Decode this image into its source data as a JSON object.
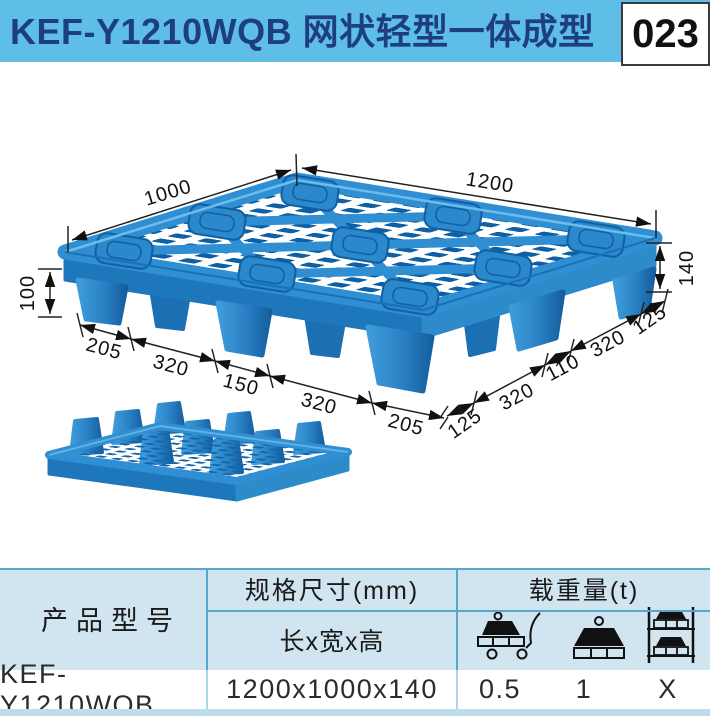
{
  "header": {
    "title": "KEF-Y1210WQB 网状轻型一体成型",
    "page_number": "023"
  },
  "drawing": {
    "dim_length": "1200",
    "dim_width": "1000",
    "dim_height": "140",
    "dim_foot_height": "100",
    "front_chain": [
      "205",
      "320",
      "150",
      "320",
      "205"
    ],
    "side_chain": [
      "125",
      "320",
      "110",
      "320",
      "125"
    ]
  },
  "table": {
    "col_product": "产品型号",
    "col_size": "规格尺寸(mm)",
    "col_size_sub": "长x宽x高",
    "col_load": "载重量(t)",
    "icons": [
      "dynamic-load-icon",
      "static-load-icon",
      "racking-load-icon"
    ],
    "row": {
      "model": "KEF-Y1210WQB",
      "size": "1200x1000x140",
      "dynamic_load": "0.5",
      "static_load": "1",
      "racking_load": "X"
    }
  },
  "colors": {
    "header_bg": "#5FBEE8",
    "header_text": "#1D3E80",
    "pallet_blue": "#2E8ECF",
    "pallet_dark": "#0D5FA6",
    "table_header_bg": "#D0E5F0",
    "table_border": "#58A6CC"
  }
}
